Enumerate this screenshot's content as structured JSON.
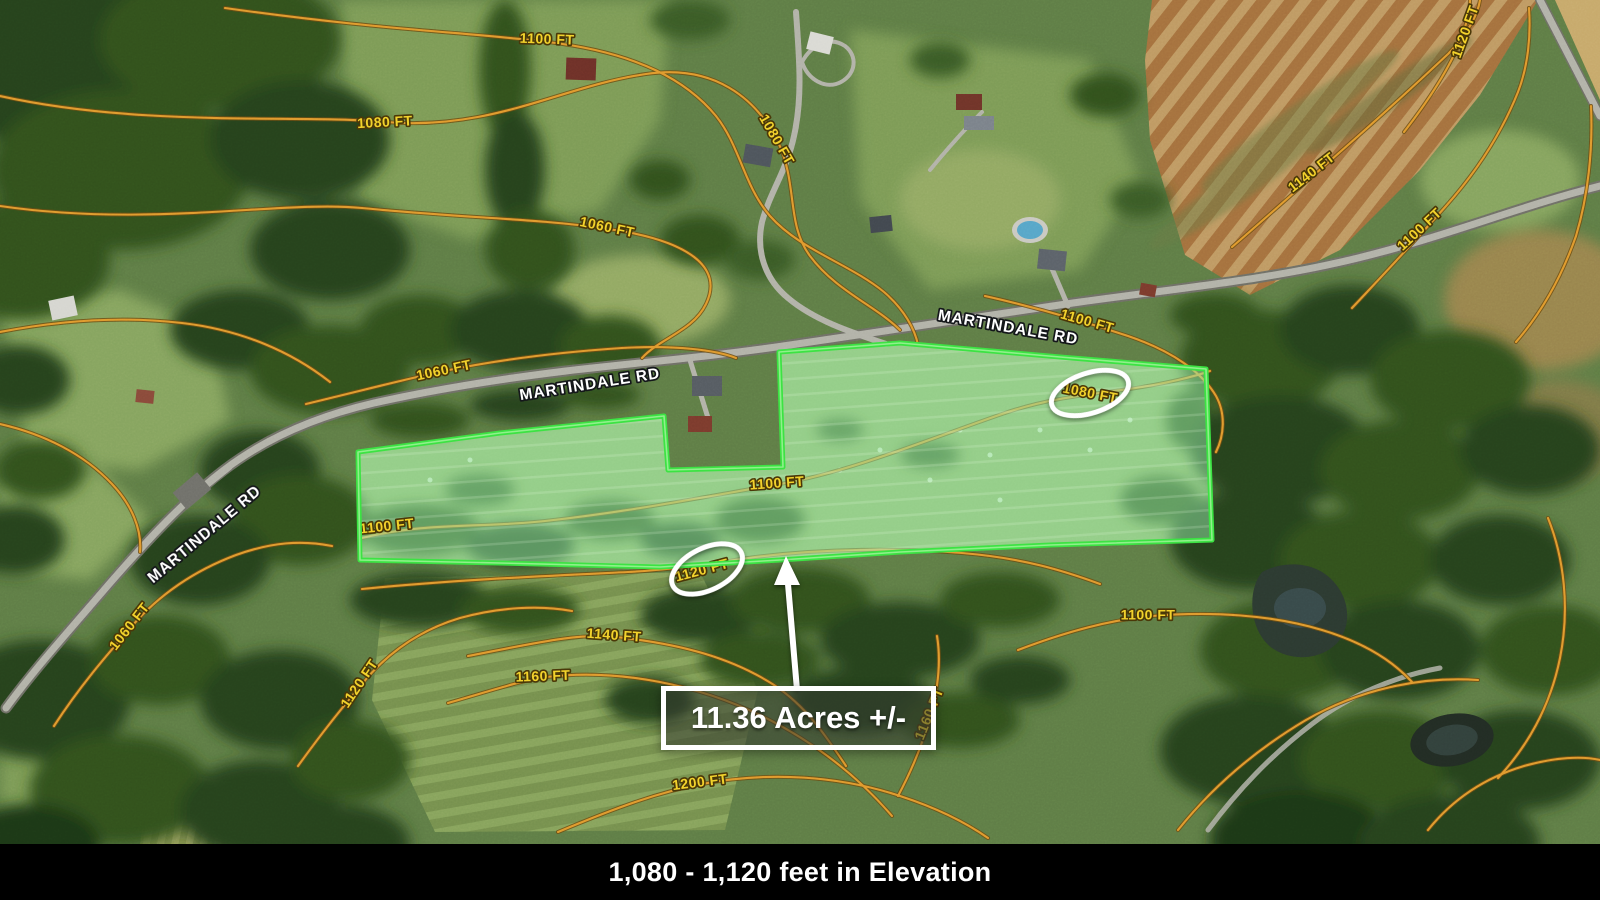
{
  "map": {
    "road_labels": [
      {
        "text": "MARTINDALE RD",
        "x": 1008,
        "y": 328,
        "rot": 10
      },
      {
        "text": "MARTINDALE RD",
        "x": 590,
        "y": 385,
        "rot": -9
      },
      {
        "text": "MARTINDALE RD",
        "x": 205,
        "y": 535,
        "rot": -40
      }
    ],
    "contour_labels": [
      {
        "text": "1100 FT",
        "x": 547,
        "y": 40,
        "rot": 2
      },
      {
        "text": "1080 FT",
        "x": 385,
        "y": 123,
        "rot": -3
      },
      {
        "text": "1080 FT",
        "x": 776,
        "y": 140,
        "rot": 60
      },
      {
        "text": "1060 FT",
        "x": 607,
        "y": 228,
        "rot": 12
      },
      {
        "text": "1140 FT",
        "x": 1312,
        "y": 173,
        "rot": -38
      },
      {
        "text": "1100 FT",
        "x": 1420,
        "y": 230,
        "rot": -43
      },
      {
        "text": "1120 FT",
        "x": 1466,
        "y": 32,
        "rot": -70
      },
      {
        "text": "1100 FT",
        "x": 1087,
        "y": 322,
        "rot": 16
      },
      {
        "text": "1060 FT",
        "x": 444,
        "y": 371,
        "rot": -12
      },
      {
        "text": "1100 FT",
        "x": 777,
        "y": 484,
        "rot": -4
      },
      {
        "text": "1100 FT",
        "x": 387,
        "y": 527,
        "rot": -6
      },
      {
        "text": "1080 FT",
        "x": 1090,
        "y": 394,
        "rot": 11
      },
      {
        "text": "1120 FT",
        "x": 702,
        "y": 571,
        "rot": -15
      },
      {
        "text": "1060 FT",
        "x": 130,
        "y": 627,
        "rot": -52
      },
      {
        "text": "1120 FT",
        "x": 360,
        "y": 684,
        "rot": -56
      },
      {
        "text": "1140 FT",
        "x": 614,
        "y": 636,
        "rot": 4
      },
      {
        "text": "1160 FT",
        "x": 543,
        "y": 677,
        "rot": -2
      },
      {
        "text": "1200 FT",
        "x": 700,
        "y": 783,
        "rot": -7
      },
      {
        "text": "1100 FT",
        "x": 1148,
        "y": 616,
        "rot": 0
      },
      {
        "text": "1160 FT",
        "x": 930,
        "y": 714,
        "rot": -68
      }
    ],
    "colors": {
      "contour_line": "#e09a2e",
      "contour_label": "#f2d22c",
      "road_label": "#ffffff",
      "boundary": "#3ce343",
      "boundary_fill": "rgba(150,235,170,0.5)",
      "highlight": "#ffffff",
      "footer_bg": "#000000",
      "footer_text": "#ffffff"
    }
  },
  "annotation": {
    "acreage_label": "11.36 Acres +/-"
  },
  "footer": {
    "text": "1,080 - 1,120 feet in Elevation"
  }
}
